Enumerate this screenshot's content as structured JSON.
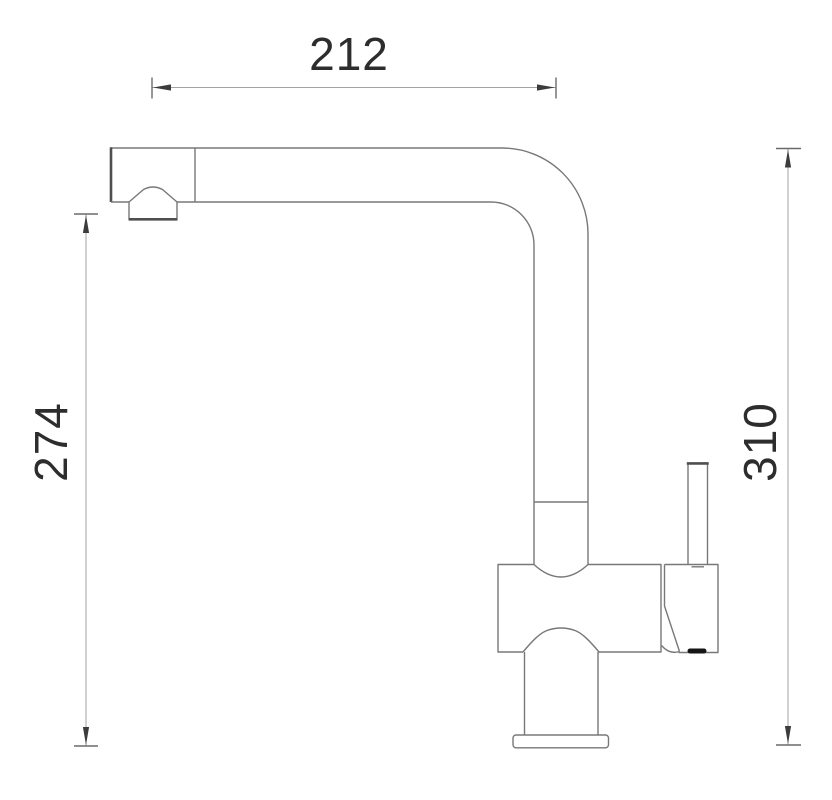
{
  "drawing": {
    "subject": "single-lever-kitchen-faucet-side-elevation",
    "dimensions": {
      "spout_reach": {
        "label": "212"
      },
      "outlet_height": {
        "label": "274"
      },
      "total_height": {
        "label": "310"
      }
    },
    "colors": {
      "outline": "#787878",
      "outline-dark": "#4f4f4f",
      "dim-line": "#a3a3a3",
      "dim-tick": "#6a6a6a",
      "arrow": "#3c3c3c",
      "label": "#2d2d2d",
      "seal": "#151515",
      "background": "#ffffff"
    }
  }
}
